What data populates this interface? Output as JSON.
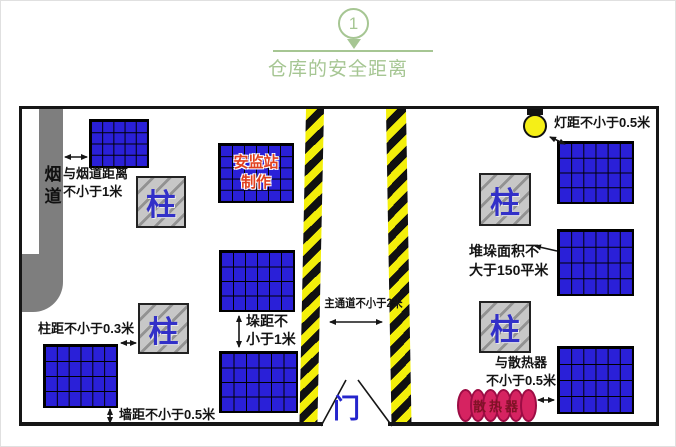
{
  "header": {
    "number": "1",
    "title": "仓库的安全距离"
  },
  "diagram": {
    "flue_label": "烟道",
    "flue_distance_line1": "与烟道距离",
    "flue_distance_line2": "不小于1米",
    "maker_line1": "安监站",
    "maker_line2": "制作",
    "column_label": "柱",
    "stack_gap_line1": "垛距不",
    "stack_gap_line2": "小于1米",
    "column_distance": "柱距不小于0.3米",
    "wall_distance": "墙距不小于0.5米",
    "aisle_label": "主通道不小于2米",
    "door_label": "门",
    "lamp_distance": "灯距不小于0.5米",
    "stack_area_line1": "堆垛面积不",
    "stack_area_line2": "大于150平米",
    "radiator_distance_line1": "与散热器",
    "radiator_distance_line2": "不小于0.5米",
    "radiator_label": "散热器"
  },
  "colors": {
    "accent_green": "#a6c693",
    "stack_blue": "#2a20d8",
    "hazard_yellow": "#f3ef0a",
    "pillar_text_blue": "#3230c8",
    "maker_red": "#e1401f",
    "door_blue": "#2525cc",
    "radiator_pink": "#d62361",
    "duct_gray": "#7e7e7e"
  }
}
